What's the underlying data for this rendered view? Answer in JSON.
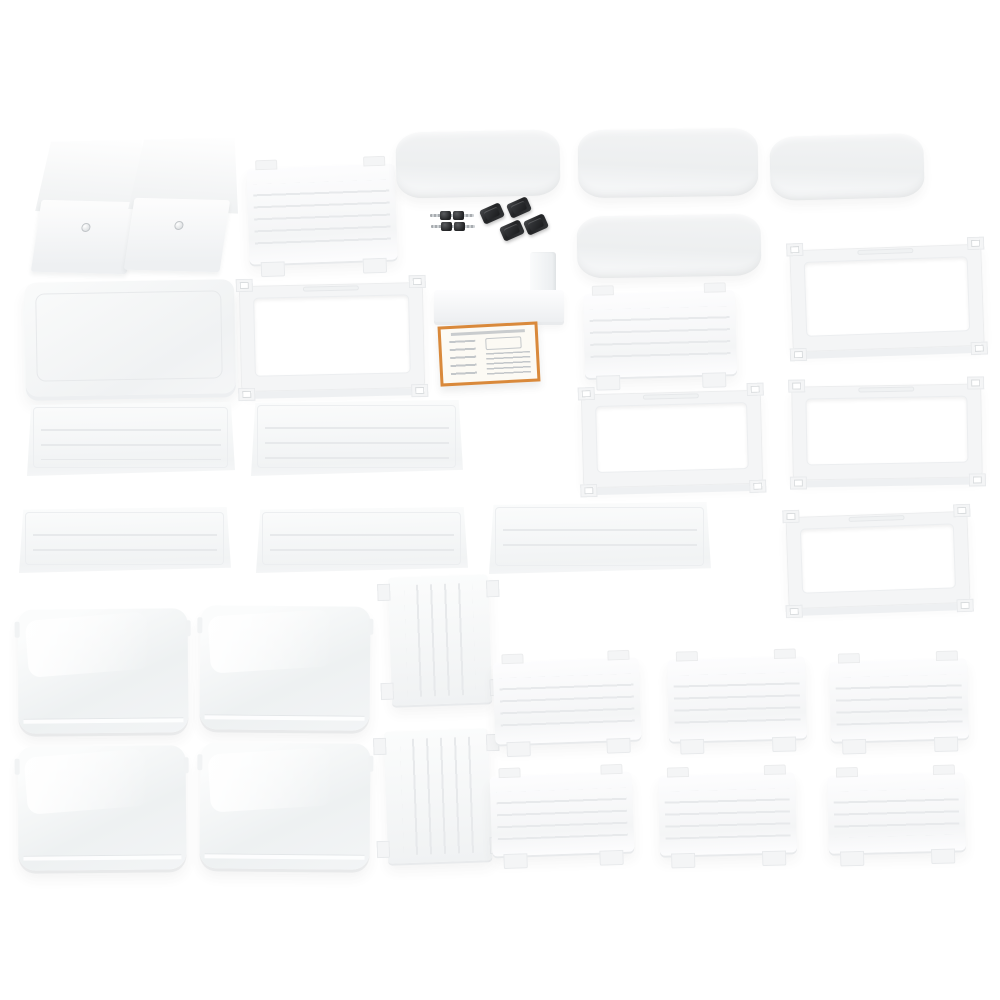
{
  "scene": {
    "title": "Product photo: unassembled white plastic refrigerator organizer parts kit on white background",
    "background": "#ffffff"
  },
  "palette": {
    "part_white": "#f4f5f6",
    "part_bright": "#fdfdfe",
    "edge": "#e8eaec",
    "groove": "#e7e9eb",
    "frost_a": "#fbfcfc",
    "frost_b": "#eef1f2",
    "hardware_black": "#222325",
    "metal": "#a7abaf",
    "manual_border": "#d9893b",
    "manual_paper": "#fcfaf4",
    "diagram_ink": "#c3c7ca"
  },
  "inventory": {
    "door_bins": 2,
    "flat_top_tray": 1,
    "slatted_divider_panels": 2,
    "curved_trim_panels": 4,
    "mounting_frames": 5,
    "slotted_shelf_boards": 5,
    "frosted_bins": 4,
    "vertical_ribbed_panels": 2,
    "small_slatted_side_panels": 6,
    "black_mounting_clips": 4,
    "screws": 4,
    "l_brackets": 1,
    "instruction_sheets": 1
  }
}
